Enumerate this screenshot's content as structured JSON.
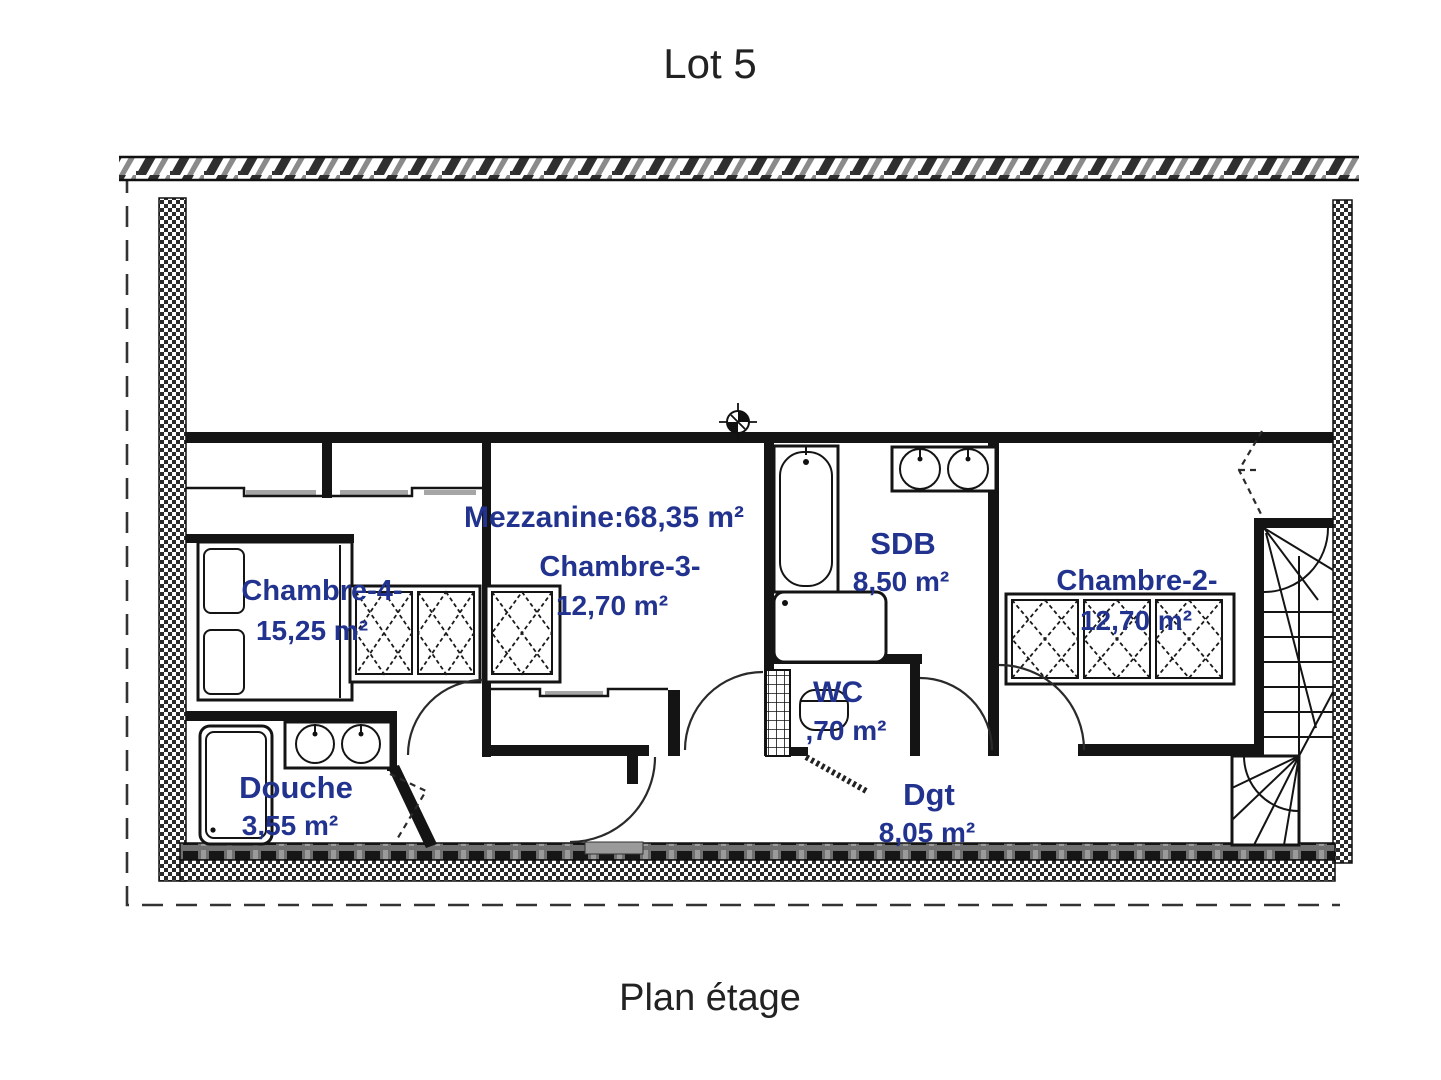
{
  "title": "Lot 5",
  "caption": "Plan étage",
  "mezzanine_label": "Mezzanine:68,35 m²",
  "rooms": {
    "chambre4": {
      "name": "Chambre-4-",
      "area": "15,25 m²"
    },
    "chambre3": {
      "name": "Chambre-3-",
      "area": "12,70 m²"
    },
    "sdb": {
      "name": "SDB",
      "area": "8,50 m²"
    },
    "chambre2": {
      "name": "Chambre-2-",
      "area": "12,70 m²"
    },
    "wc": {
      "name": "WC",
      "area": ",70 m²"
    },
    "douche": {
      "name": "Douche",
      "area": "3,55 m²"
    },
    "dgt": {
      "name": "Dgt",
      "area": "8,05 m²"
    }
  },
  "colors": {
    "room_label": "#22338f",
    "line": "#141414",
    "title_ink": "#222222"
  }
}
